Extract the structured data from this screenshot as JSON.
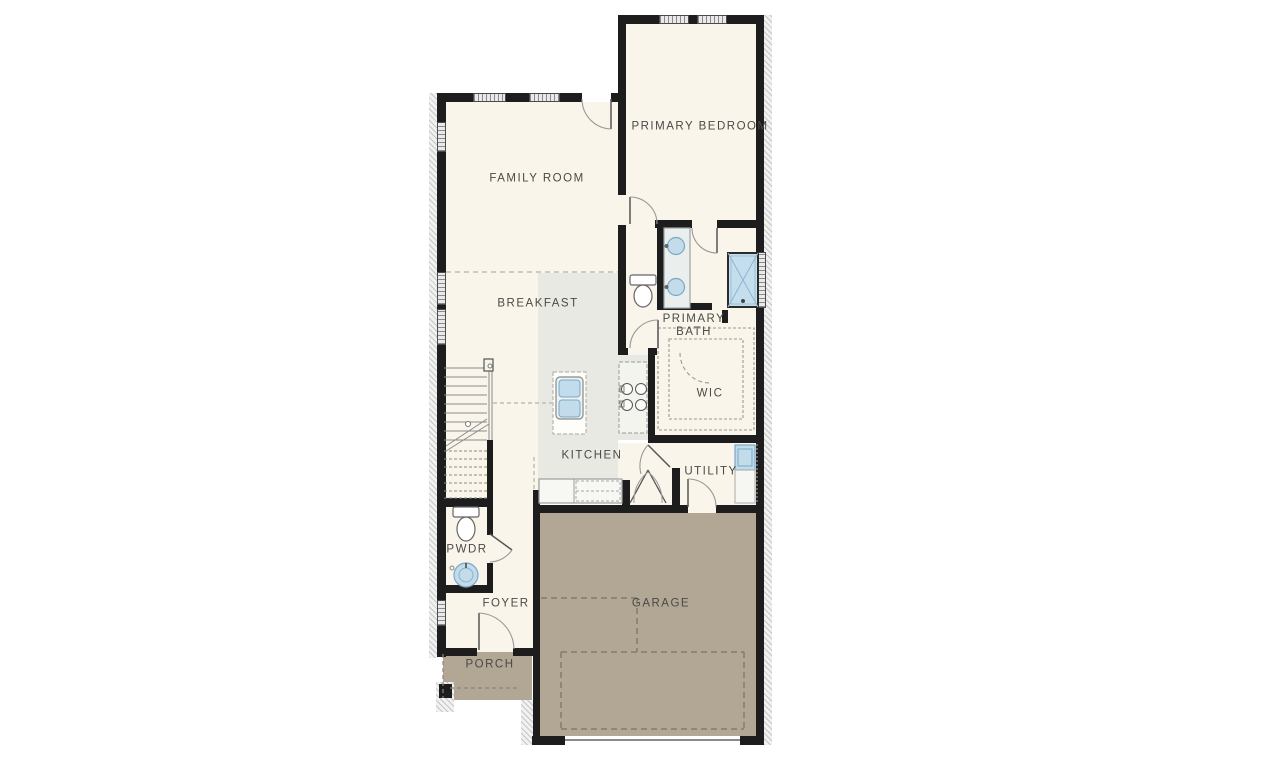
{
  "page": {
    "type": "architectural first-floor plan",
    "background": "#ffffff"
  },
  "plan": {
    "rooms": [
      {
        "id": "family-room",
        "label": "FAMILY ROOM"
      },
      {
        "id": "primary-bedroom",
        "label": "PRIMARY BEDROOM"
      },
      {
        "id": "breakfast",
        "label": "BREAKFAST"
      },
      {
        "id": "primary-bath",
        "label": "PRIMARY BATH"
      },
      {
        "id": "wic",
        "label": "WIC"
      },
      {
        "id": "kitchen",
        "label": "KITCHEN"
      },
      {
        "id": "utility",
        "label": "UTILITY"
      },
      {
        "id": "pwdr",
        "label": "PWDR"
      },
      {
        "id": "foyer",
        "label": "FOYER"
      },
      {
        "id": "garage",
        "label": "GARAGE"
      },
      {
        "id": "porch",
        "label": "PORCH"
      }
    ],
    "colors": {
      "wall": "#1d1d1d",
      "floor_cream": "#faf5eb",
      "floor_kitchen_gray": "#e9e9e4",
      "floor_garage_tan": "#b2a695",
      "fixture_blue": "#c2dcec",
      "label_text": "#4a4a46"
    },
    "fixtures": [
      "stairs",
      "island-sink",
      "cooktop",
      "base-counter",
      "double-vanity",
      "toilet",
      "shower",
      "wic-shelving",
      "washer",
      "powder-toilet",
      "powder-round-sink",
      "doors",
      "windows"
    ]
  }
}
